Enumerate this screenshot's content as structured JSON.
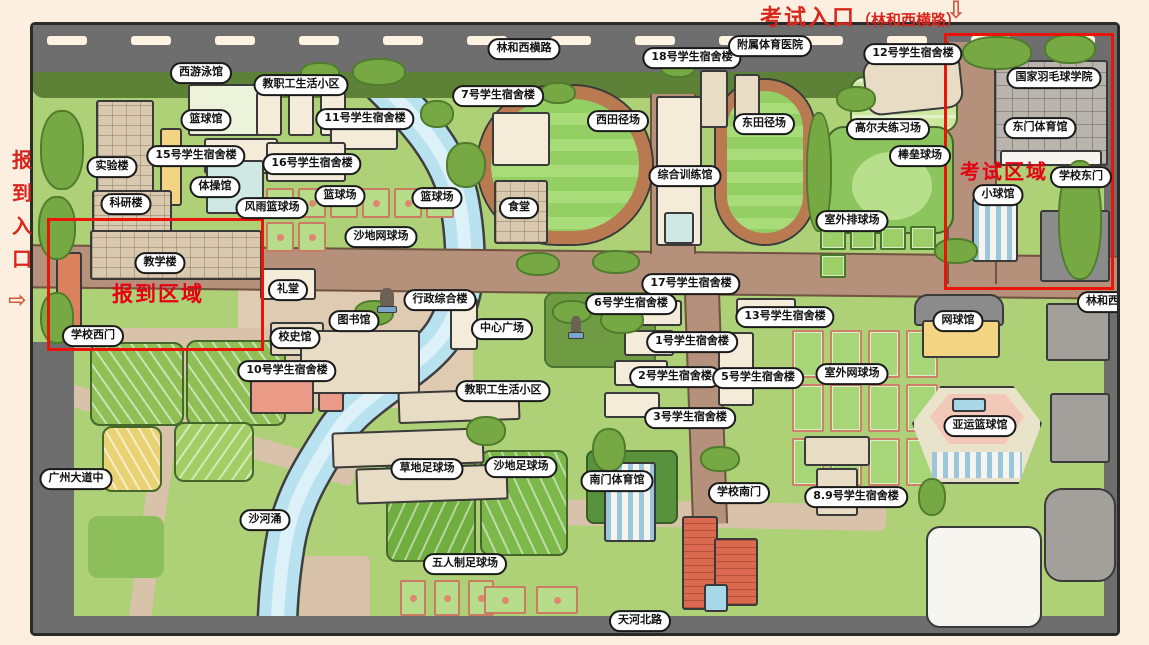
{
  "annotations": {
    "exam_entrance_title": "考试入口",
    "exam_entrance_road": "（林和西横路）",
    "exam_entrance_arrow": "⇩",
    "report_entrance_chars": [
      "报",
      "到",
      "入",
      "口"
    ],
    "report_entrance_arrow": "⇨",
    "report_area_label": "报到区域",
    "exam_area_label": "考试区域"
  },
  "roads": {
    "north": "林和西横路",
    "south": "天河北路",
    "west": "广州大道中",
    "east": "林和西路",
    "river": "沙河涌"
  },
  "map_labels": [
    {
      "text": "林和西横路",
      "x": 524,
      "y": 49
    },
    {
      "text": "西游泳馆",
      "x": 201,
      "y": 73
    },
    {
      "text": "教职工生活小区",
      "x": 301,
      "y": 85
    },
    {
      "text": "篮球馆",
      "x": 206,
      "y": 120
    },
    {
      "text": "11号学生宿舍楼",
      "x": 365,
      "y": 119
    },
    {
      "text": "15号学生宿舍楼",
      "x": 196,
      "y": 156
    },
    {
      "text": "16号学生宿舍楼",
      "x": 312,
      "y": 164
    },
    {
      "text": "实验楼",
      "x": 112,
      "y": 167
    },
    {
      "text": "体操馆",
      "x": 215,
      "y": 187
    },
    {
      "text": "科研楼",
      "x": 126,
      "y": 204
    },
    {
      "text": "风雨篮球场",
      "x": 272,
      "y": 208
    },
    {
      "text": "篮球场",
      "x": 340,
      "y": 196
    },
    {
      "text": "篮球场",
      "x": 437,
      "y": 198
    },
    {
      "text": "沙地网球场",
      "x": 381,
      "y": 237
    },
    {
      "text": "教学楼",
      "x": 160,
      "y": 263
    },
    {
      "text": "学校西门",
      "x": 93,
      "y": 336
    },
    {
      "text": "礼堂",
      "x": 288,
      "y": 290
    },
    {
      "text": "校史馆",
      "x": 295,
      "y": 338
    },
    {
      "text": "10号学生宿舍楼",
      "x": 287,
      "y": 371
    },
    {
      "text": "图书馆",
      "x": 354,
      "y": 321
    },
    {
      "text": "行政综合楼",
      "x": 440,
      "y": 300
    },
    {
      "text": "中心广场",
      "x": 502,
      "y": 329
    },
    {
      "text": "教职工生活小区",
      "x": 503,
      "y": 391
    },
    {
      "text": "7号学生宿舍楼",
      "x": 498,
      "y": 96
    },
    {
      "text": "食堂",
      "x": 519,
      "y": 208
    },
    {
      "text": "西田径场",
      "x": 618,
      "y": 121
    },
    {
      "text": "综合训练馆",
      "x": 685,
      "y": 176
    },
    {
      "text": "18号学生宿舍楼",
      "x": 692,
      "y": 58
    },
    {
      "text": "附属体育医院",
      "x": 770,
      "y": 46
    },
    {
      "text": "东田径场",
      "x": 764,
      "y": 124
    },
    {
      "text": "12号学生宿舍楼",
      "x": 913,
      "y": 54
    },
    {
      "text": "高尔夫练习场",
      "x": 888,
      "y": 129
    },
    {
      "text": "棒垒球场",
      "x": 920,
      "y": 156
    },
    {
      "text": "室外排球场",
      "x": 852,
      "y": 221
    },
    {
      "text": "国家羽毛球学院",
      "x": 1054,
      "y": 78
    },
    {
      "text": "东门体育馆",
      "x": 1040,
      "y": 128
    },
    {
      "text": "学校东门",
      "x": 1081,
      "y": 177
    },
    {
      "text": "小球馆",
      "x": 998,
      "y": 195
    },
    {
      "text": "林和西路",
      "x": 1108,
      "y": 302
    },
    {
      "text": "17号学生宿舍楼",
      "x": 691,
      "y": 284
    },
    {
      "text": "6号学生宿舍楼",
      "x": 631,
      "y": 304
    },
    {
      "text": "13号学生宿舍楼",
      "x": 785,
      "y": 317
    },
    {
      "text": "1号学生宿舍楼",
      "x": 692,
      "y": 342
    },
    {
      "text": "2号学生宿舍楼",
      "x": 675,
      "y": 377
    },
    {
      "text": "5号学生宿舍楼",
      "x": 758,
      "y": 378
    },
    {
      "text": "3号学生宿舍楼",
      "x": 690,
      "y": 418
    },
    {
      "text": "室外网球场",
      "x": 852,
      "y": 374
    },
    {
      "text": "网球馆",
      "x": 958,
      "y": 321
    },
    {
      "text": "亚运篮球馆",
      "x": 980,
      "y": 426
    },
    {
      "text": "草地足球场",
      "x": 427,
      "y": 469
    },
    {
      "text": "沙地足球场",
      "x": 521,
      "y": 467
    },
    {
      "text": "五人制足球场",
      "x": 465,
      "y": 564
    },
    {
      "text": "南门体育馆",
      "x": 617,
      "y": 481
    },
    {
      "text": "学校南门",
      "x": 739,
      "y": 493
    },
    {
      "text": "8.9号学生宿舍楼",
      "x": 856,
      "y": 497
    },
    {
      "text": "天河北路",
      "x": 640,
      "y": 621
    },
    {
      "text": "沙河涌",
      "x": 265,
      "y": 520
    },
    {
      "text": "广州大道中",
      "x": 76,
      "y": 479
    }
  ],
  "colors": {
    "accent_red": "#e60012",
    "entrance_red": "#d9261c",
    "road_gray": "#6e6e6e",
    "campus_path_brown": "#b5917b",
    "grass_green": "#aed178",
    "river_blue": "#b9e2f0",
    "page_background": "#fcefdf"
  }
}
